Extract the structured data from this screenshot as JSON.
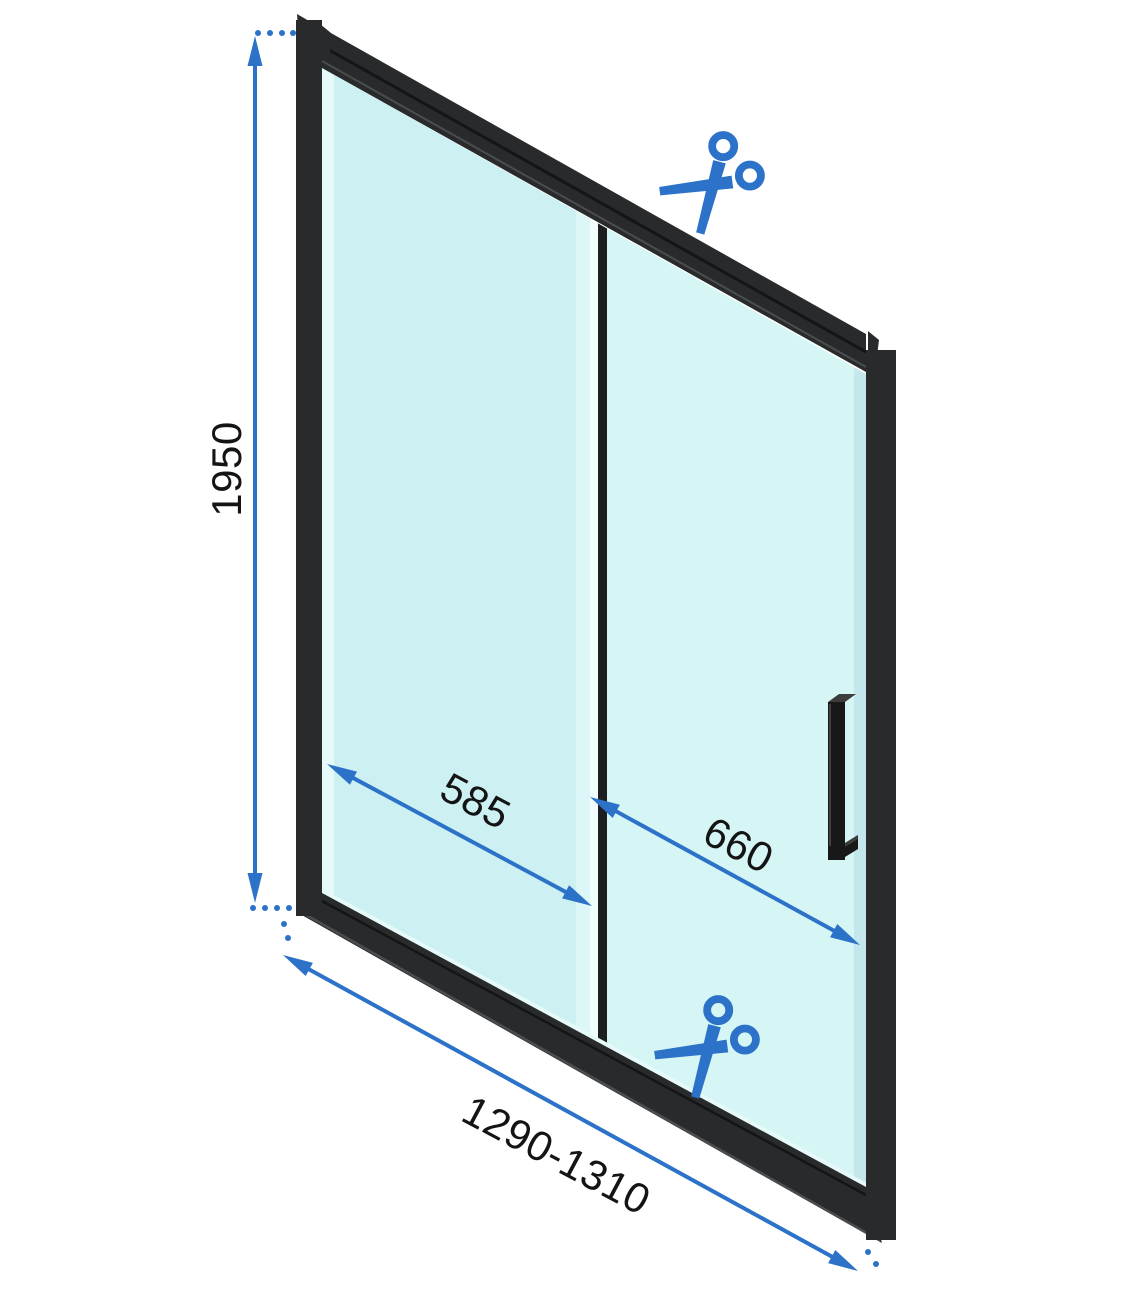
{
  "page": {
    "background": "#FFFFFF"
  },
  "colors": {
    "accent_blue": "#2B72C8",
    "frame_black": "#282A2C",
    "frame_dark_groove": "#141516",
    "frame_highlight": "#4A4D4F",
    "divider_black": "#1C1E1F",
    "glass_left_panel": "#CDF1F3",
    "glass_right_panel": "#D6F6F6",
    "glass_edge_light": "#E6FAFA",
    "glass_inner_strip": "#DDF7F8",
    "glass_edge_bright": "#F0FCFD",
    "glass_right_edge_shade": "#C3E7EC",
    "handle_dark": "#181818",
    "handle_top_face": "#3D3D3D",
    "label_text": "#141414"
  },
  "dimensions": {
    "height": {
      "label": "1950"
    },
    "fixed_panel_width": {
      "label": "585"
    },
    "door_panel_width": {
      "label": "660"
    },
    "overall_width_range": {
      "label": "1290-1310"
    }
  },
  "icons": {
    "top_scissors": "scissors-icon",
    "bottom_scissors": "scissors-icon"
  }
}
